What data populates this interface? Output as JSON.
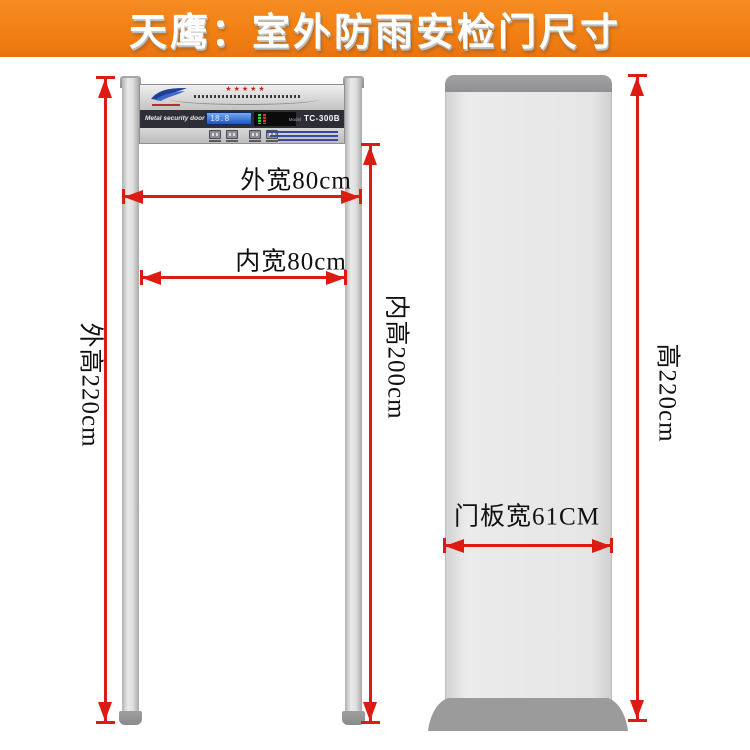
{
  "banner": {
    "title": "天鹰：室外防雨安检门尺寸",
    "bg_color": "#f28114",
    "text_color": "#ffffff"
  },
  "colors": {
    "dimension_red": "#dc1b12",
    "pillar_gray": "#d9d9d9",
    "cap_gray": "#9b9b9b",
    "band_dark": "#2e2e36",
    "lcd_blue": "#2a62cc",
    "star_red": "#c41f1f"
  },
  "front_view": {
    "head_unit": {
      "stars": "★★★★★",
      "band_label": "Metal security door",
      "lcd_digits": "18.8",
      "model_label": "Model",
      "model_value": "TC-300B"
    },
    "dim_outer_width": {
      "label": "外宽80cm"
    },
    "dim_inner_width": {
      "label": "内宽80cm"
    },
    "dim_outer_height": {
      "label": "外高220cm"
    },
    "dim_inner_height": {
      "label": "内高200cm"
    }
  },
  "side_view": {
    "dim_height": {
      "label": "高220cm"
    },
    "dim_panel_width": {
      "label": "门板宽61CM"
    }
  }
}
